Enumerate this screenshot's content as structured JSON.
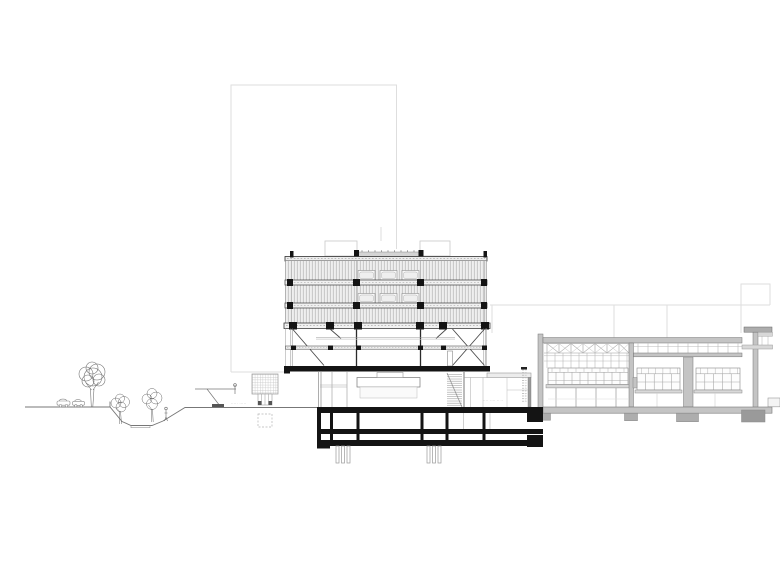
{
  "annotations": {
    "ground_label_left": "····· ·····",
    "ground_label_right": "···· ···· – ··",
    "level_marks_vertical": "·· ··· ·· ···"
  },
  "palette": {
    "paper": "#ffffff",
    "cut_primary": "#141414",
    "structure_dark": "#3c3c3c",
    "structure_gray": "#8a8a8a",
    "context_cut_fill": "#c4c4c4",
    "footing_gray": "#adadad",
    "ghost_line": "#dedede",
    "vegetation": "#6a6a6a",
    "annotation_gray": "#a8a8a8"
  }
}
